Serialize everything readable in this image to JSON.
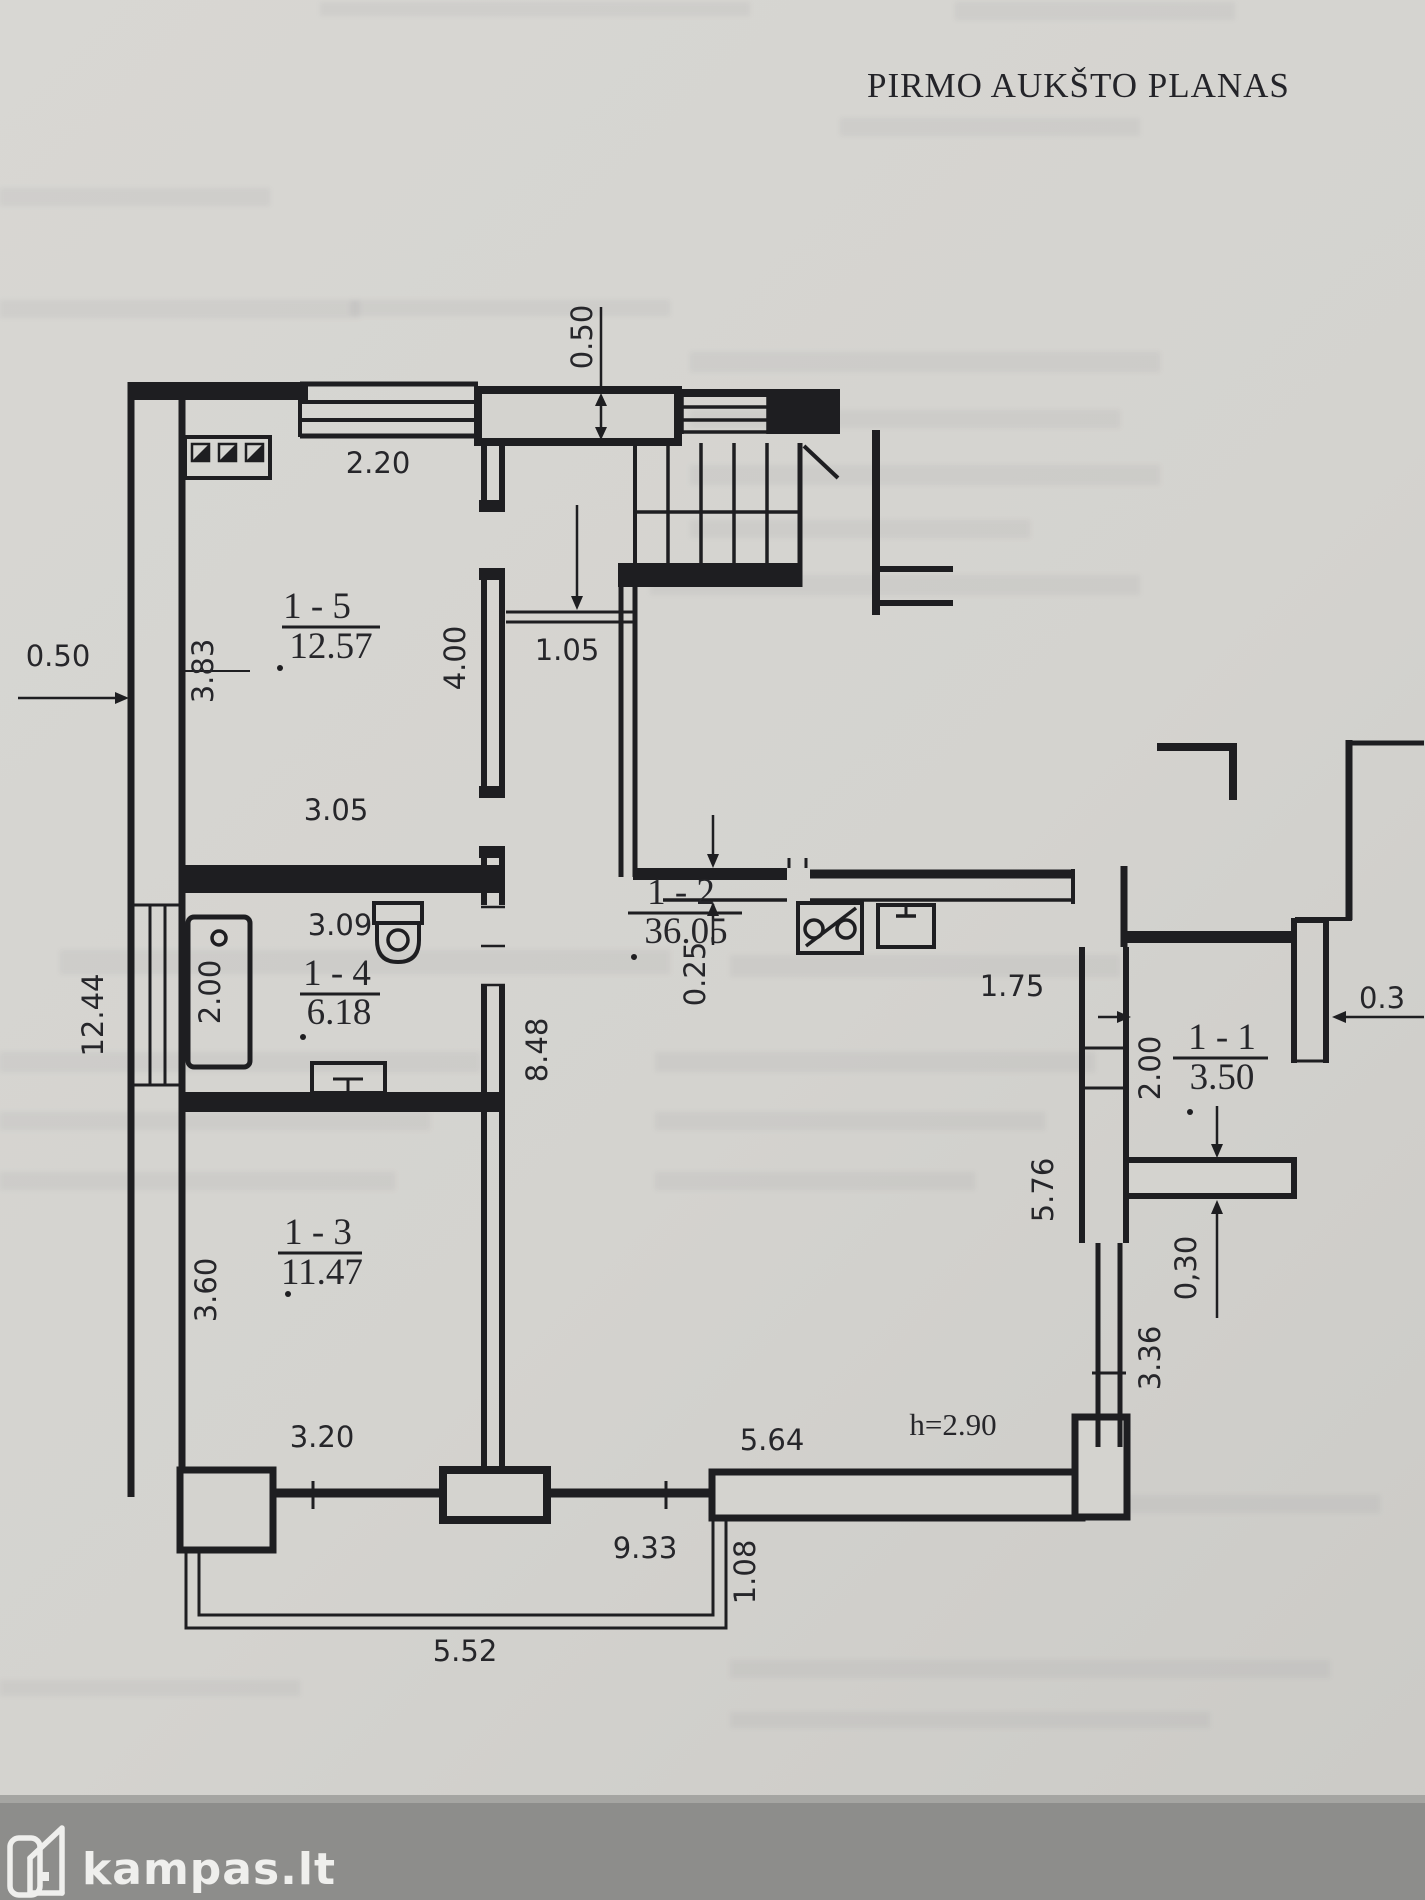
{
  "title": "PIRMO AUKŠTO PLANAS",
  "watermark": {
    "brand": "kampas.lt"
  },
  "plan": {
    "rooms": [
      {
        "id": "1 - 5",
        "area": "12.57"
      },
      {
        "id": "1 - 4",
        "area": "6.18"
      },
      {
        "id": "1 - 3",
        "area": "11.47"
      },
      {
        "id": "1 - 2",
        "area": "36.05"
      },
      {
        "id": "1 - 1",
        "area": "3.50"
      }
    ],
    "ceiling_height": "h=2.90",
    "dims": {
      "top_offset": "0.50",
      "window_15": "2.20",
      "room15_depth": "4.00",
      "room15_west": "3.83",
      "west_wall": "0.50",
      "stair_door": "1.05",
      "room15_width": "3.05",
      "room14_width": "3.09",
      "bathtub": "2.00",
      "west_total": "12.44",
      "hall_depth": "8.48",
      "partition": "0.25",
      "room11_width": "1.75",
      "east_wall_top": "0.3",
      "room11_depth": "2.00",
      "east_upper": "5.76",
      "east_wall_bottom": "0,30",
      "east_lower": "3.36",
      "room13_west": "3.60",
      "room13_width": "3.20",
      "south_right": "5.64",
      "south_center": "9.33",
      "porch_east": "1.08",
      "porch_south": "5.52"
    }
  },
  "colors": {
    "paper": "#d4d3cf",
    "ink": "#1e1e21",
    "photo_edge": "#8d8d8b",
    "watermark": "#efefed"
  }
}
